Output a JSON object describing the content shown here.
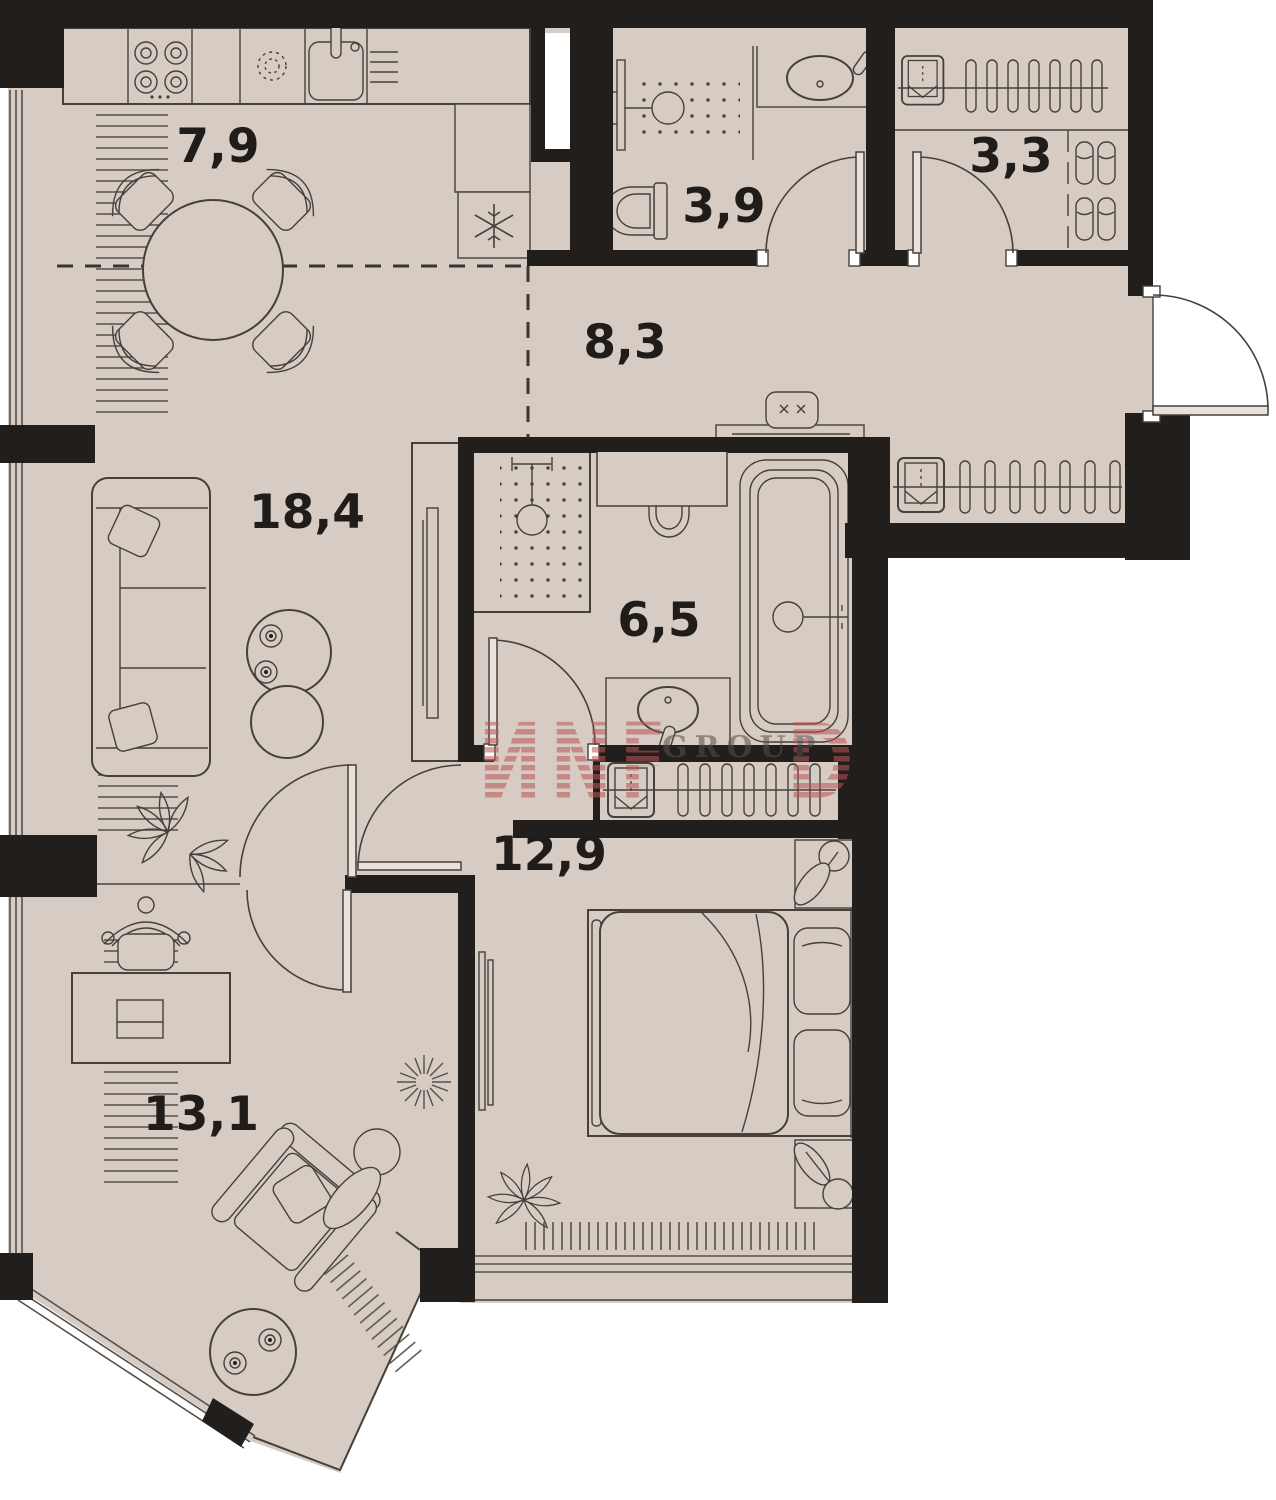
{
  "floorplan": {
    "rooms": [
      {
        "id": "kitchen-dining",
        "area": "7,9"
      },
      {
        "id": "bathroom",
        "area": "3,9"
      },
      {
        "id": "wardrobe",
        "area": "3,3"
      },
      {
        "id": "hallway",
        "area": "8,3"
      },
      {
        "id": "living-room",
        "area": "18,4"
      },
      {
        "id": "bathroom-main",
        "area": "6,5"
      },
      {
        "id": "bedroom",
        "area": "12,9"
      },
      {
        "id": "study",
        "area": "13,1"
      }
    ],
    "watermark": {
      "glyph_left": "И",
      "letter_n": "N",
      "letter_f": "F",
      "glyph_right": "D",
      "group_text": "GROUP",
      "color": "#bc5357"
    },
    "colors": {
      "floor": "#d6ccc3",
      "walls": "#211e1c",
      "furniture_lines": "#45403a",
      "watermark_red": "#bc5357",
      "background": "#ffffff"
    }
  }
}
